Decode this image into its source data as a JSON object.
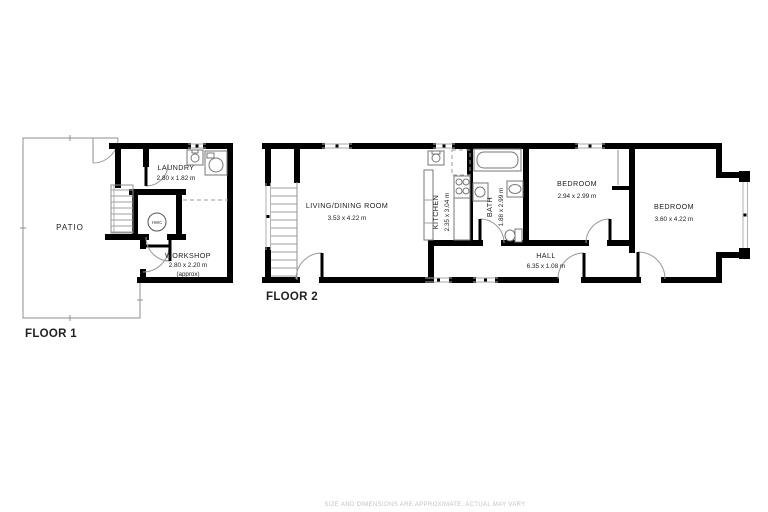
{
  "floor1": {
    "label": "FLOOR 1",
    "rooms": {
      "patio": {
        "name": "PATIO"
      },
      "laundry": {
        "name": "LAUNDRY",
        "dims": "2.80 x 1.82 m"
      },
      "workshop": {
        "name": "WORKSHOP",
        "dims": "2.80 x 2.20 m",
        "note": "(approx)"
      },
      "hwc": {
        "name": "HWC"
      }
    }
  },
  "floor2": {
    "label": "FLOOR 2",
    "rooms": {
      "living": {
        "name": "LIVING/DINING ROOM",
        "dims": "3.53 x 4.22 m"
      },
      "kitchen": {
        "name": "KITCHEN",
        "dims": "2.35 x 3.04 m"
      },
      "bath": {
        "name": "BATH",
        "dims": "1.88 x 2.99 m"
      },
      "bedroom1": {
        "name": "BEDROOM",
        "dims": "2.94 x 2.99 m"
      },
      "hall": {
        "name": "HALL",
        "dims": "6.35 x 1.08 m"
      },
      "bedroom2": {
        "name": "BEDROOM",
        "dims": "3.60 x 4.22 m"
      }
    }
  },
  "footer": {
    "disclaimer": "SIZE AND DIMENSIONS ARE APPROXIMATE, ACTUAL MAY VARY"
  },
  "colors": {
    "wall": "#000000",
    "thin_line": "#9a9a9a",
    "text": "#1c1c1c",
    "footer_text": "#c3c3c3"
  }
}
